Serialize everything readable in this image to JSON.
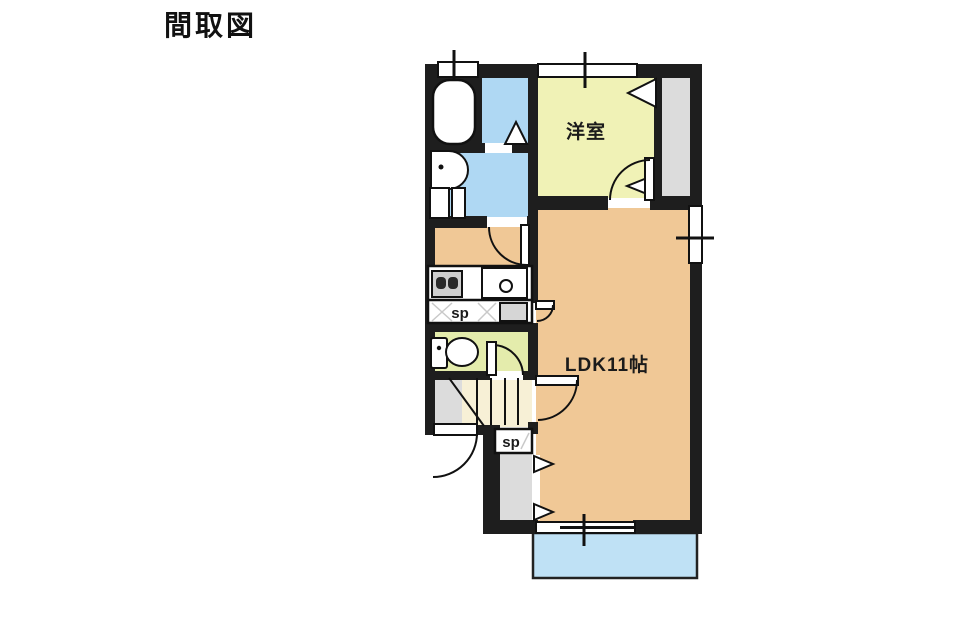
{
  "title": "間取図",
  "plan": {
    "rooms": {
      "western_room": "洋室",
      "ldk": "LDK11帖",
      "storage_upper": "sp",
      "storage_lower": "sp"
    },
    "colors": {
      "wall": "#1e1e1e",
      "ldk_floor": "#F0C896",
      "western_room_floor": "#F0F2B6",
      "toilet_floor": "#E4ECAC",
      "bath_floor": "#AFD8F3",
      "balcony_floor": "#BFE1F5",
      "closet_floor": "#DCDCDC",
      "stairs_floor": "#F7F0D6",
      "landing_floor": "#DCDCDC"
    }
  }
}
